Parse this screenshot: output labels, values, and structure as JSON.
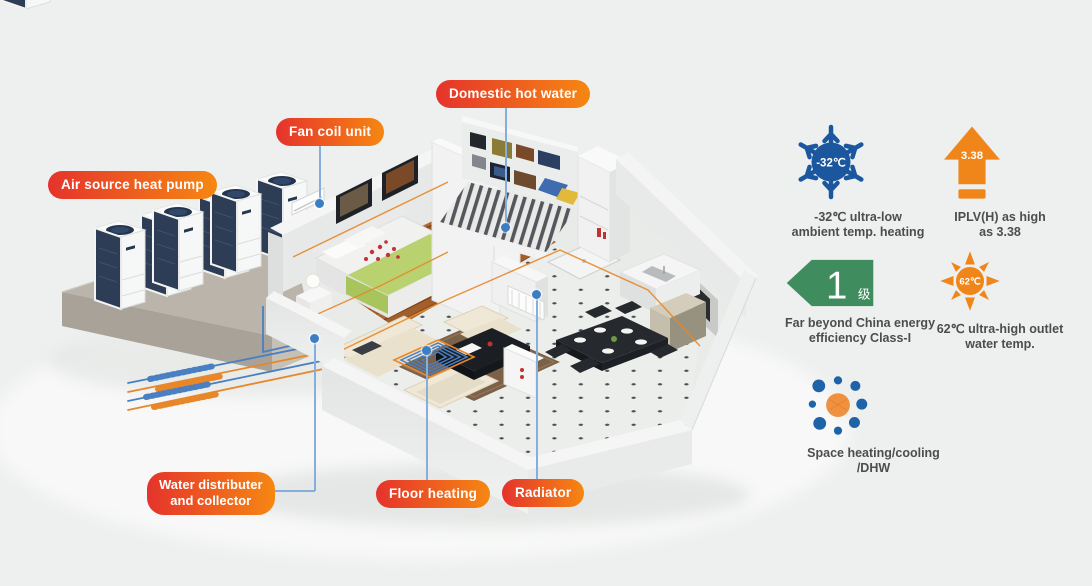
{
  "scene": {
    "background": "#eef0ef",
    "callouts": {
      "air_source_heat_pump": "Air source heat pump",
      "fan_coil_unit": "Fan coil unit",
      "domestic_hot_water": "Domestic hot water",
      "water_distributer_line1": "Water distributer",
      "water_distributer_line2": "and collector",
      "floor_heating": "Floor heating",
      "radiator": "Radiator"
    }
  },
  "features": {
    "ultra_low": {
      "badge": "-32℃",
      "line1": "-32℃ ultra-low",
      "line2": "ambient temp. heating"
    },
    "iplv": {
      "badge": "3.38",
      "line1": "IPLV(H) as high",
      "line2": "as 3.38"
    },
    "energy_class": {
      "badge_number": "1",
      "badge_unit": "级",
      "line1": "Far beyond China energy",
      "line2": "efficiency Class-I"
    },
    "outlet_temp": {
      "badge": "62℃",
      "line1": "62℃ ultra-high outlet",
      "line2": "water temp."
    },
    "modes": {
      "line1": "Space heating/cooling",
      "line2": "/DHW"
    }
  },
  "colors": {
    "label_gradient_start": "#e5332c",
    "label_gradient_end": "#f68712",
    "leader_line": "#85aedd",
    "leader_dot": "#3b7ec2",
    "icon_blue": "#1a579f",
    "icon_orange": "#f08519",
    "icon_green": "#3f8c5e",
    "pipe_orange": "#e8872a",
    "pipe_blue": "#4a7fc1"
  }
}
